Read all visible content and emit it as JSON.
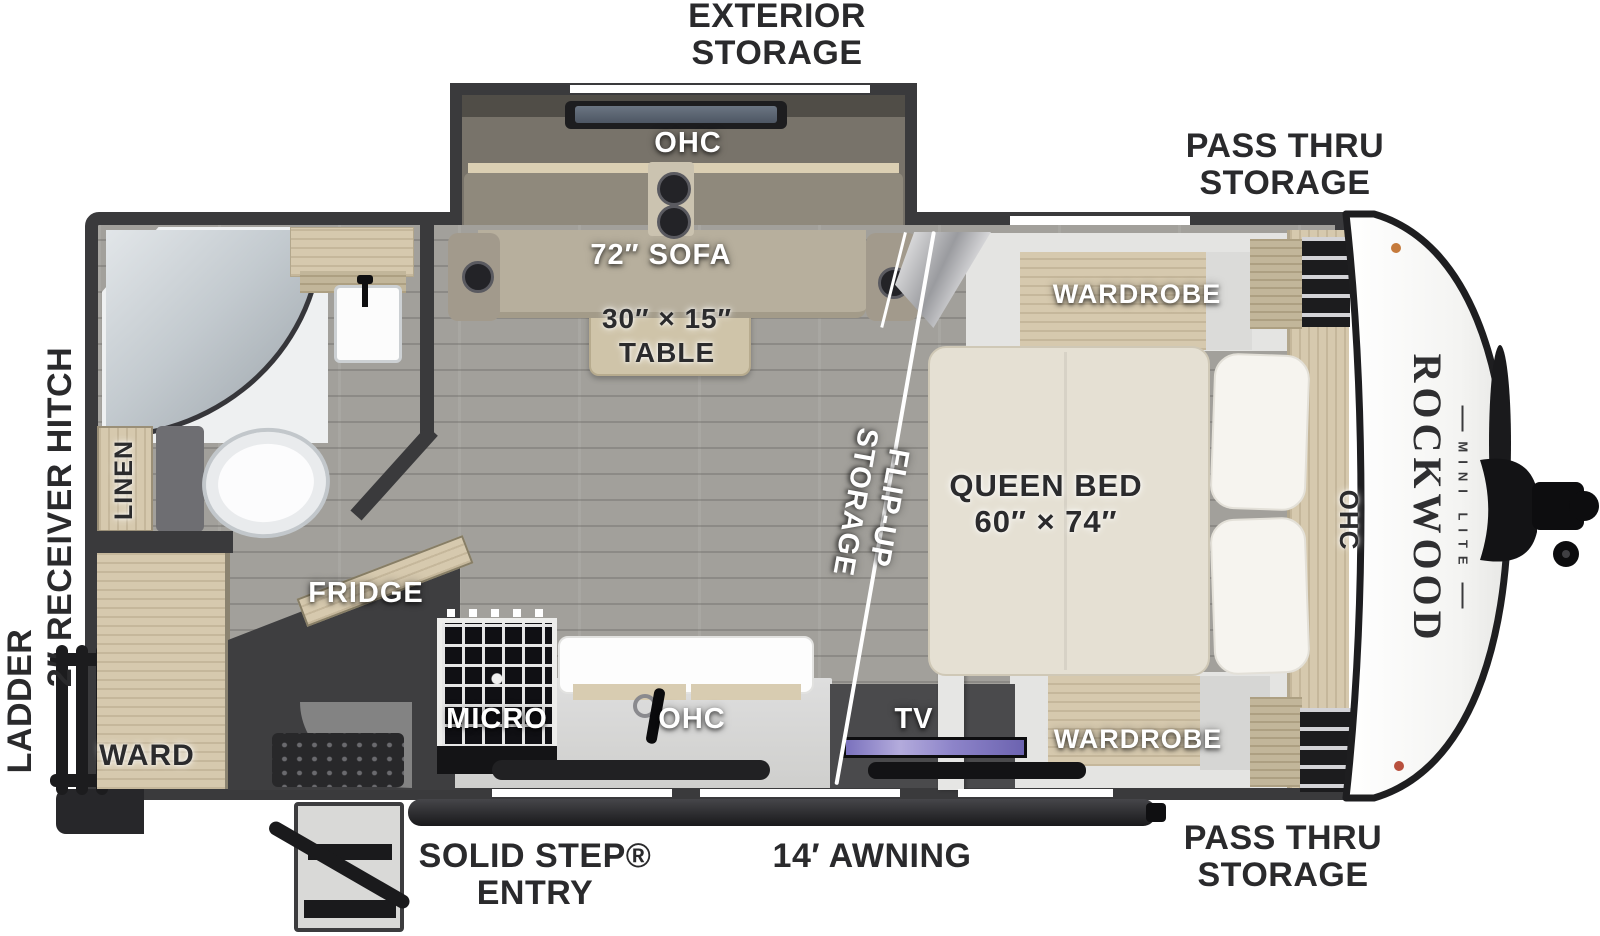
{
  "labels_outside": {
    "exterior_storage": "EXTERIOR\nSTORAGE",
    "pass_thru_top": "PASS THRU\nSTORAGE",
    "pass_thru_bottom": "PASS THRU\nSTORAGE",
    "solid_step": "SOLID STEP®\nENTRY",
    "awning": "14′ AWNING",
    "ladder": "LADDER",
    "receiver_hitch": "2″ RECEIVER HITCH"
  },
  "labels_inside": {
    "ohc_slide": "OHC",
    "sofa": "72″ SOFA",
    "table": "30″ × 15″\nTABLE",
    "wardrobe_top": "WARDROBE",
    "queen_bed": "QUEEN BED\n60″ × 74″",
    "ohc_front": "OHC",
    "flip_up": "FLIP-UP\nSTORAGE",
    "linen": "LINEN",
    "ward": "WARD",
    "fridge": "FRIDGE",
    "micro": "MICRO",
    "ohc_kitchen": "OHC",
    "tv": "TV",
    "wardrobe_bottom": "WARDROBE"
  },
  "brand": {
    "name": "ROCKWOOD",
    "series": "MINI LITE"
  },
  "colors": {
    "wall": "#3a3a3c",
    "floor": "#a2a09b",
    "wood": "#d6c9ae",
    "sofa": "#b7af9d",
    "bed": "#e5e0d3",
    "table": "#cfc4a9",
    "tv_screen": "#8a81c6",
    "label_dark": "#2a2a2c",
    "label_white": "#ffffff",
    "front_cap": "#f7f7f5"
  },
  "icons": {
    "ladder": "css-shape",
    "entry_steps": "css-shape",
    "doormat": "css-shape",
    "awning_bar": "css-shape",
    "shower": "css-shape",
    "toilet": "css-shape",
    "bath_sink": "css-shape",
    "stove": "css-shape",
    "kitchen_faucet": "css-shape",
    "tv_screen": "css-shape",
    "soundbar": "css-shape",
    "cupholder": "css-shape",
    "window": "css-shape",
    "hitch": "svg-shape",
    "flip_panel": "css-shape"
  }
}
